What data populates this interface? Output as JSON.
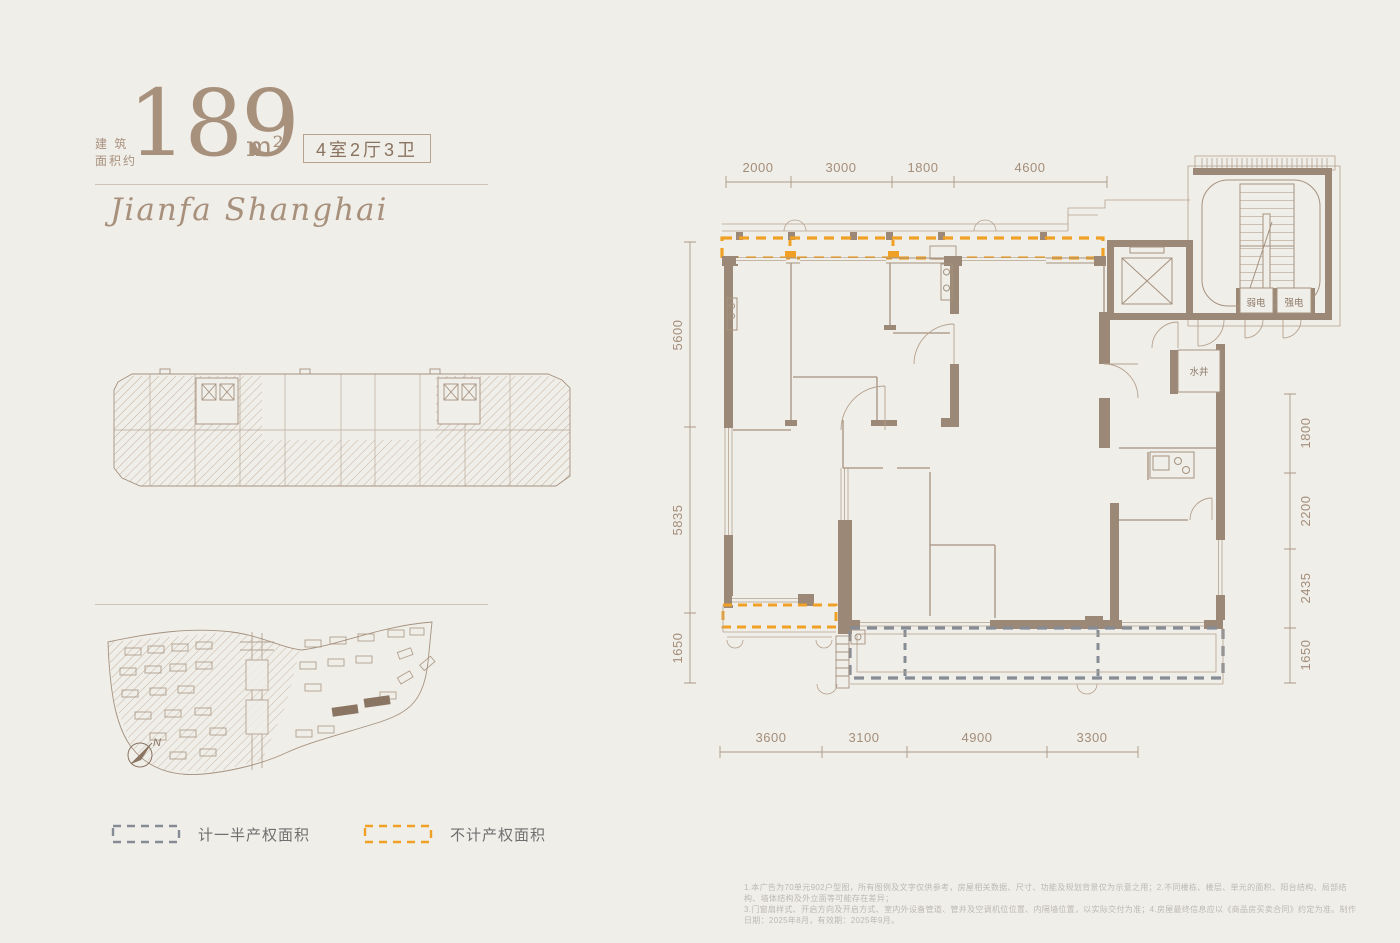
{
  "header": {
    "area_prefix_line1": "建 筑",
    "area_prefix_line2": "面积约",
    "area_value": "189",
    "area_unit": "m²",
    "layout_badge": "4室2厅3卫"
  },
  "brand": {
    "script": "Jianfa Shanghai"
  },
  "siteplan": {
    "north_label": "N"
  },
  "legend": {
    "items": [
      {
        "label": "计一半产权面积",
        "color": "#868c95"
      },
      {
        "label": "不计产权面积",
        "color": "#f0a125"
      }
    ]
  },
  "plan": {
    "rooms": {
      "weak": "弱电",
      "strong": "强电",
      "water": "水井"
    },
    "dims": {
      "top": [
        "2000",
        "3000",
        "1800",
        "4600"
      ],
      "left": [
        "5600",
        "5835",
        "1650"
      ],
      "right": [
        "1800",
        "2200",
        "2435",
        "1650"
      ],
      "bottom": [
        "3600",
        "3100",
        "4900",
        "3300"
      ]
    }
  },
  "disclaimer": {
    "line1": "1.本广告为70单元902户型图，所有图例及文字仅供参考，房屋相关数据、尺寸、功能及规划背景仅为示意之用；2.不同楼栋、楼层、单元的面积、阳台结构、局部结构、墙体结构及外立面等可能存在差异；",
    "line2": "3.门窗扇样式、开启方向及开启方式、室内外设备管道、管井及空调机位位置、内隔墙位置，以实际交付为准；4.房屋最终信息应以《商品房买卖合同》约定为准。制作日期：2025年8月，有效期：2025年9月。"
  }
}
